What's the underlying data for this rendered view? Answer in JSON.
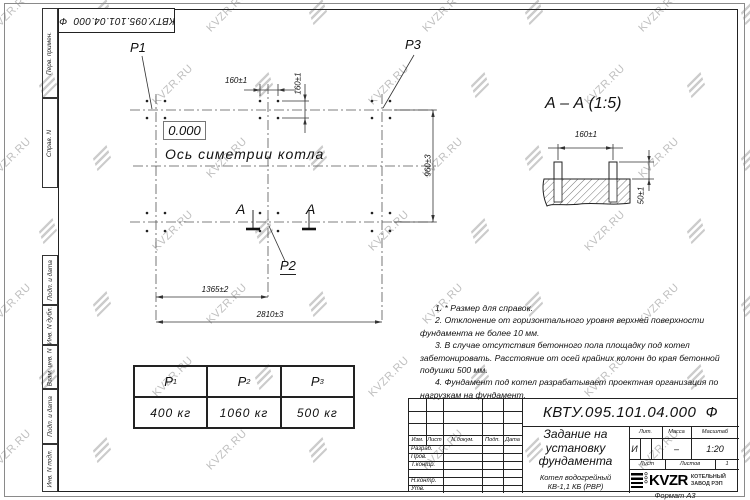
{
  "designation": "КВТУ.095.101.04.000  Ф",
  "watermark": {
    "text": "KVZR.RU"
  },
  "side_strips": [
    "Перв. примен.",
    "Справ. N",
    "Подп. и дата",
    "Инв. N дубл.",
    "Взам. инв. N",
    "Подп. и дата",
    "Инв. N подл."
  ],
  "plan": {
    "labels": {
      "p1": "P1",
      "p2": "P2",
      "p3": "P3",
      "elevation": "0.000",
      "axis": "Ось симетрии котла",
      "section_letter": "A"
    },
    "dims": {
      "d160_top": "160±1",
      "d160_vert": "160±1",
      "d960": "960±3",
      "d1365": "1365±2",
      "d2810": "2810±3"
    }
  },
  "section_view": {
    "title": "А – А (1:5)",
    "dims": {
      "d160": "160±1",
      "d50": "50±1"
    }
  },
  "notes": [
    "1. * Размер для справок.",
    "2. Отклонение от горизонтального уровня верхней поверхности фундамента не более 10 мм.",
    "3. В случае отсутствия бетонного пола площадку под котел забетонировать. Расстояние от осей крайних колонн до края бетонной подушки 500 мм.",
    "4. Фундамент под котел разрабатывает проектная организация по нагрузкам на фундамент."
  ],
  "load_table": {
    "headers": [
      {
        "base": "P",
        "sub": "1"
      },
      {
        "base": "P",
        "sub": "2"
      },
      {
        "base": "P",
        "sub": "3"
      }
    ],
    "values": [
      "400 кг",
      "1060 кг",
      "500 кг"
    ]
  },
  "title_block": {
    "doc_title": "Задание на установку фундамента",
    "product_line1": "Котел водогрейный",
    "product_line2": "КВ-1,1 КБ (РВР)",
    "header_cols": [
      "Изм.",
      "Лист",
      "N докум.",
      "Подп.",
      "Дата"
    ],
    "rows": [
      "Разраб.",
      "Пров.",
      "Т.контр.",
      "",
      "Н.контр.",
      "Утв."
    ],
    "lit_label": "Лит.",
    "lit_value": "И",
    "mass_label": "Масса",
    "mass_value": "–",
    "scale_label": "Масштаб",
    "scale_value": "1:20",
    "sheet_label": "Лист",
    "sheets_label": "Листов",
    "sheets_value": "1",
    "logo_ooo": "ООО",
    "logo_text": "KVZR",
    "company_line1": "КОТЕЛЬНЫЙ",
    "company_line2": "ЗАВОД РЭП",
    "format": "Формат А3"
  },
  "colors": {
    "line": "#222222",
    "watermark": "#bfbfbf"
  }
}
